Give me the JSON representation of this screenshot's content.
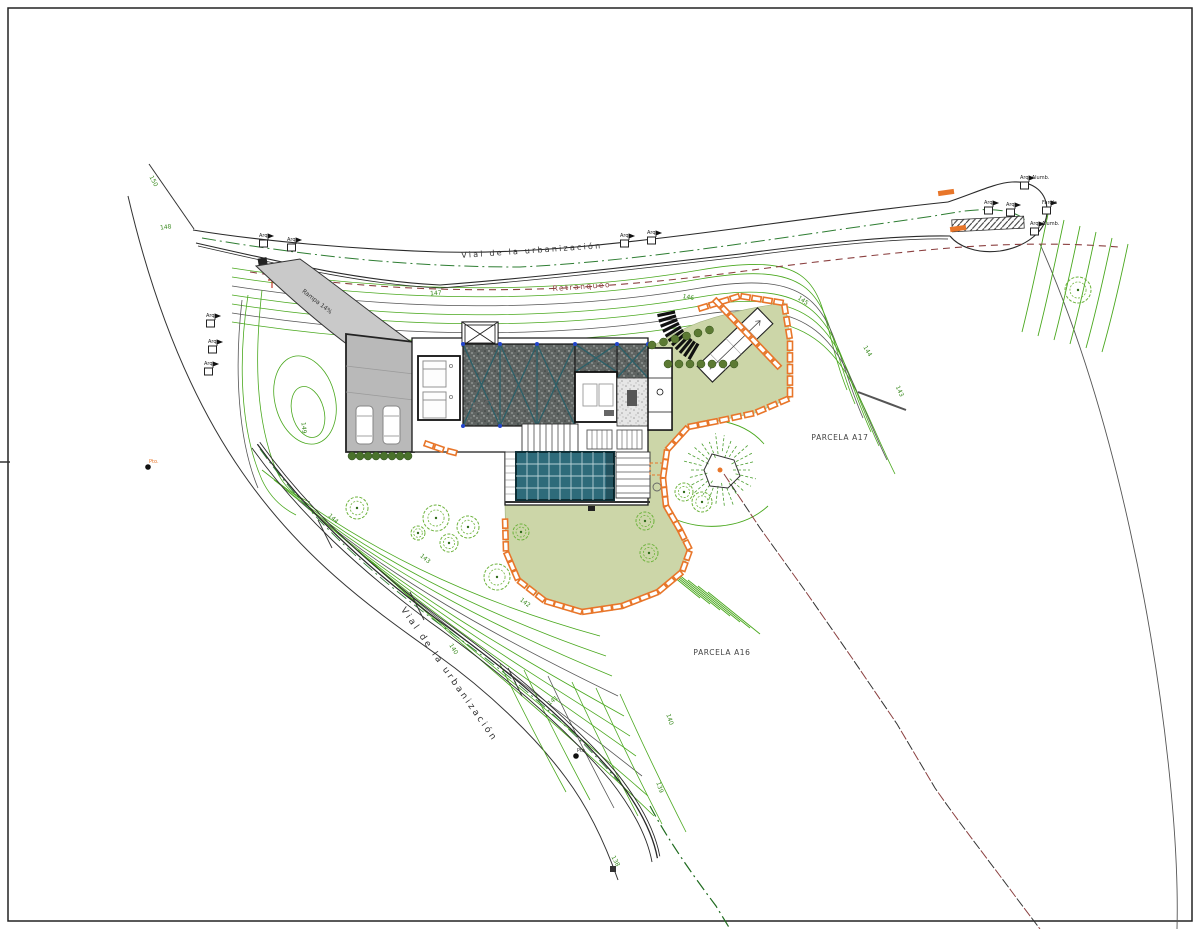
{
  "page": {
    "background": "#ffffff",
    "frame_color": "#222222"
  },
  "labels": {
    "road_top": "Vial de la urbanización",
    "road_bottom": "Vial de la urbanización",
    "setback": "Retranqueo",
    "parcel_a17": "PARCELA A17",
    "parcel_a16": "PARCELA A16",
    "ramp": "Rampa 14%"
  },
  "colors": {
    "contour_green": "#4aa81e",
    "contour_dark": "#555555",
    "boundary_green": "#2e7d32",
    "setback_red": "#8b4040",
    "wall_orange": "#e8762a",
    "pool_teal": "#2e6b7a",
    "pool_grid": "#cfe3e6",
    "lawn_olive": "#ccd6a8",
    "roof_teal": "#2e6068",
    "driveway_gray": "#b9b9b9",
    "ramp_gray": "#c9c9c9",
    "tree_green": "#6db33c",
    "shrub_green": "#5c7a33",
    "line_black": "#2a2a2a"
  },
  "contour_labels": [
    {
      "text": "150",
      "x": 152,
      "y": 182,
      "rot": 62
    },
    {
      "text": "148",
      "x": 166,
      "y": 229,
      "rot": -8
    },
    {
      "text": "147",
      "x": 436,
      "y": 295,
      "rot": -4
    },
    {
      "text": "146",
      "x": 688,
      "y": 299,
      "rot": 10
    },
    {
      "text": "145",
      "x": 802,
      "y": 302,
      "rot": 35
    },
    {
      "text": "144",
      "x": 866,
      "y": 352,
      "rot": 60
    },
    {
      "text": "143",
      "x": 898,
      "y": 392,
      "rot": 65
    },
    {
      "text": "149",
      "x": 302,
      "y": 428,
      "rot": 85
    },
    {
      "text": "144",
      "x": 332,
      "y": 520,
      "rot": 42
    },
    {
      "text": "143",
      "x": 424,
      "y": 560,
      "rot": 40
    },
    {
      "text": "142",
      "x": 524,
      "y": 604,
      "rot": 38
    },
    {
      "text": "141",
      "x": 554,
      "y": 702,
      "rot": -38
    },
    {
      "text": "140",
      "x": 452,
      "y": 650,
      "rot": 58
    },
    {
      "text": "140",
      "x": 668,
      "y": 720,
      "rot": 72
    },
    {
      "text": "139",
      "x": 658,
      "y": 788,
      "rot": 72
    },
    {
      "text": "138",
      "x": 614,
      "y": 862,
      "rot": 62
    }
  ],
  "utility_symbols": [
    {
      "label": "Arq.",
      "x": 263,
      "y": 238
    },
    {
      "label": "Arq.",
      "x": 291,
      "y": 242
    },
    {
      "label": "Arq.",
      "x": 624,
      "y": 238
    },
    {
      "label": "Arq.",
      "x": 651,
      "y": 235
    },
    {
      "label": "Arq.",
      "x": 988,
      "y": 205
    },
    {
      "label": "Arq.",
      "x": 1010,
      "y": 207
    },
    {
      "label": "Arq. Alumb.",
      "x": 1024,
      "y": 180
    },
    {
      "label": "Arq. Alumb.",
      "x": 1034,
      "y": 226
    },
    {
      "label": "Farola",
      "x": 1046,
      "y": 205
    },
    {
      "label": "Arq.",
      "x": 210,
      "y": 318
    },
    {
      "label": "Arq.",
      "x": 212,
      "y": 344
    },
    {
      "label": "Arq.",
      "x": 208,
      "y": 366
    }
  ],
  "survey_points": [
    {
      "label": "Pto.",
      "x": 148,
      "y": 467,
      "kind": "orange"
    },
    {
      "label": "Pto.",
      "x": 576,
      "y": 756,
      "kind": "dark"
    }
  ]
}
